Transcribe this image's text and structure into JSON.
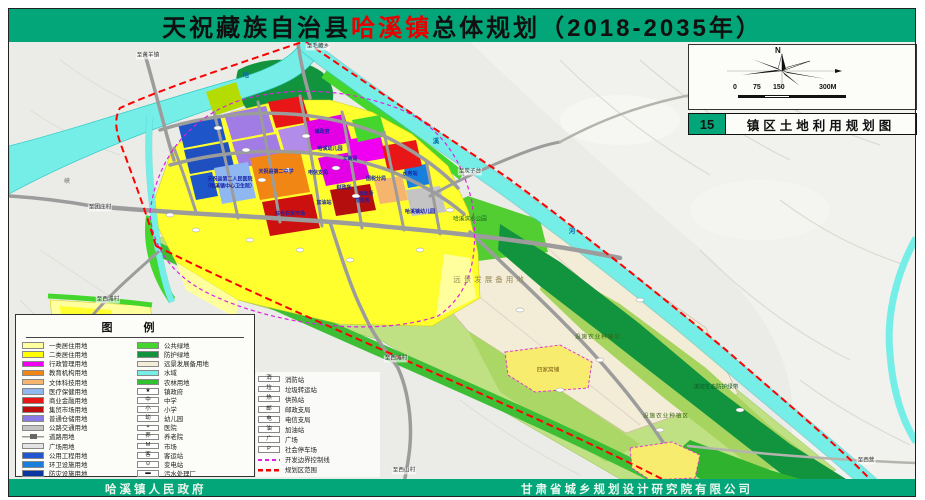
{
  "colors": {
    "title_bg": "#03A678",
    "title_highlight": "#E60000",
    "boundary_red": "#FF0000",
    "dev_boundary_magenta": "#E020E0",
    "water": "#76EEE8"
  },
  "title": {
    "prefix": "天祝藏族自治县",
    "highlight": "哈溪镇",
    "suffix": "总体规划（2018-2035年）"
  },
  "north": {
    "label": "N"
  },
  "scale_ticks": [
    {
      "x": 44,
      "t": "0"
    },
    {
      "x": 64,
      "t": "75"
    },
    {
      "x": 84,
      "t": "150"
    },
    {
      "x": 130,
      "t": "300M"
    }
  ],
  "map_index": {
    "number": "15",
    "name": "镇区土地利用规划图"
  },
  "footer": {
    "left": "哈溪镇人民政府",
    "right": "甘肃省城乡规划设计研究院有限公司"
  },
  "legend": {
    "title": "图 例",
    "col1": [
      {
        "kind": "fill",
        "color": "#FFFF9E",
        "label": "一类居住用地"
      },
      {
        "kind": "fill",
        "color": "#FFFF00",
        "label": "二类居住用地"
      },
      {
        "kind": "fill",
        "color": "#F000F0",
        "label": "行政管理用地"
      },
      {
        "kind": "fill",
        "color": "#F28614",
        "label": "教育机构用地"
      },
      {
        "kind": "fill",
        "color": "#F5B56E",
        "label": "文体科技用地"
      },
      {
        "kind": "fill",
        "color": "#8FB8F2",
        "label": "医疗保健用地"
      },
      {
        "kind": "fill",
        "color": "#E81616",
        "label": "商业金融用地"
      },
      {
        "kind": "fill",
        "color": "#BE0E0E",
        "label": "集贸市场用地"
      },
      {
        "kind": "fill",
        "color": "#8A7AE8",
        "label": "普通仓储用地"
      },
      {
        "kind": "fill",
        "color": "#C4C4C4",
        "label": "公路交通用地"
      },
      {
        "kind": "road",
        "label": "道路用地"
      },
      {
        "kind": "fill",
        "color": "#E4E4E4",
        "label": "广场用地"
      },
      {
        "kind": "fill",
        "color": "#2255D0",
        "label": "公用工程用地"
      },
      {
        "kind": "fill",
        "color": "#1880DC",
        "label": "环卫设施用地"
      },
      {
        "kind": "fill",
        "color": "#0A38A0",
        "label": "防灾设施用地"
      }
    ],
    "col2": [
      {
        "kind": "fill",
        "color": "#45D62E",
        "label": "公共绿地"
      },
      {
        "kind": "fill",
        "color": "#12933D",
        "label": "防护绿地"
      },
      {
        "kind": "fill",
        "color": "#F3ECD6",
        "label": "远景发展备用地"
      },
      {
        "kind": "fill",
        "color": "#76EEE8",
        "label": "水域"
      },
      {
        "kind": "fill",
        "color": "#2FC42F",
        "label": "农林用地"
      },
      {
        "kind": "sym",
        "glyph": "★",
        "label": "镇政府"
      },
      {
        "kind": "sym",
        "glyph": "中",
        "label": "中学"
      },
      {
        "kind": "sym",
        "glyph": "小",
        "label": "小学"
      },
      {
        "kind": "sym",
        "glyph": "幼",
        "label": "幼儿园"
      },
      {
        "kind": "sym",
        "glyph": "+",
        "label": "医院"
      },
      {
        "kind": "sym",
        "glyph": "养",
        "label": "养老院"
      },
      {
        "kind": "sym",
        "glyph": "M",
        "label": "市场"
      },
      {
        "kind": "sym",
        "glyph": "客",
        "label": "客运站"
      },
      {
        "kind": "sym",
        "glyph": "⊙",
        "label": "变电站"
      },
      {
        "kind": "sym",
        "glyph": "▬",
        "label": "污水处理厂"
      }
    ],
    "col3": [
      {
        "kind": "sym",
        "glyph": "消",
        "label": "消防站"
      },
      {
        "kind": "sym",
        "glyph": "垃",
        "label": "垃圾转运站"
      },
      {
        "kind": "sym",
        "glyph": "热",
        "label": "供热站"
      },
      {
        "kind": "sym",
        "glyph": "邮",
        "label": "邮政支局"
      },
      {
        "kind": "sym",
        "glyph": "电",
        "label": "电信支局"
      },
      {
        "kind": "sym",
        "glyph": "油",
        "label": "加油站"
      },
      {
        "kind": "sym",
        "glyph": "广",
        "label": "广场"
      },
      {
        "kind": "sym",
        "glyph": "P",
        "label": "社会停车场"
      },
      {
        "kind": "dashm",
        "label": "开发边界控制线"
      },
      {
        "kind": "dashr",
        "label": "规划区范围"
      }
    ]
  },
  "map": {
    "labels": [
      {
        "x": 148,
        "y": 56,
        "text": "至黄羊镇",
        "cls": "road"
      },
      {
        "x": 318,
        "y": 47,
        "text": "至毛藏乡",
        "cls": "road"
      },
      {
        "x": 470,
        "y": 172,
        "text": "至炭子台",
        "cls": "road"
      },
      {
        "x": 100,
        "y": 208,
        "text": "至团庄村",
        "cls": "road"
      },
      {
        "x": 108,
        "y": 300,
        "text": "至西滩村",
        "cls": "road"
      },
      {
        "x": 396,
        "y": 359,
        "text": "至西滩村",
        "cls": "road"
      },
      {
        "x": 404,
        "y": 471,
        "text": "至西山村",
        "cls": "road"
      },
      {
        "x": 866,
        "y": 461,
        "text": "至西营",
        "cls": "road"
      },
      {
        "x": 67,
        "y": 183,
        "text": "峡",
        "cls": "terrain"
      },
      {
        "x": 246,
        "y": 76,
        "text": "哈",
        "cls": "river"
      },
      {
        "x": 436,
        "y": 142,
        "text": "溪",
        "cls": "river"
      },
      {
        "x": 572,
        "y": 232,
        "text": "河",
        "cls": "river"
      },
      {
        "x": 490,
        "y": 280,
        "text": "远景发展备用地",
        "cls": "beige"
      },
      {
        "x": 470,
        "y": 220,
        "text": "哈溪滨水公园",
        "cls": "green"
      },
      {
        "x": 598,
        "y": 338,
        "text": "设施农业种植区",
        "cls": "agri"
      },
      {
        "x": 666,
        "y": 417,
        "text": "设施农业种植区",
        "cls": "agri"
      },
      {
        "x": 716,
        "y": 388,
        "text": "滨河生态防护绿带",
        "cls": "green"
      },
      {
        "x": 548,
        "y": 371,
        "text": "四家窝铺",
        "cls": "village"
      },
      {
        "x": 276,
        "y": 172,
        "text": "天祝县第二中学",
        "cls": "fac"
      },
      {
        "x": 230,
        "y": 183,
        "text": "天祝县第二人民医院\n（哈溪镇中心卫生院）",
        "cls": "fac"
      },
      {
        "x": 290,
        "y": 214,
        "text": "综合农贸市场",
        "cls": "fac"
      },
      {
        "x": 330,
        "y": 149,
        "text": "哈溪幼儿园",
        "cls": "fac"
      },
      {
        "x": 350,
        "y": 159,
        "text": "工商局",
        "cls": "fac"
      },
      {
        "x": 318,
        "y": 173,
        "text": "电信支局",
        "cls": "fac"
      },
      {
        "x": 376,
        "y": 179,
        "text": "国税分局",
        "cls": "fac"
      },
      {
        "x": 344,
        "y": 188,
        "text": "财政所",
        "cls": "fac"
      },
      {
        "x": 366,
        "y": 194,
        "text": "派出所",
        "cls": "fac"
      },
      {
        "x": 362,
        "y": 201,
        "text": "司法所",
        "cls": "fac"
      },
      {
        "x": 324,
        "y": 203,
        "text": "加油站",
        "cls": "fac"
      },
      {
        "x": 410,
        "y": 174,
        "text": "水务站",
        "cls": "fac"
      },
      {
        "x": 322,
        "y": 132,
        "text": "镇政府",
        "cls": "fac"
      },
      {
        "x": 420,
        "y": 212,
        "text": "哈溪镇幼儿园",
        "cls": "fac"
      }
    ]
  }
}
